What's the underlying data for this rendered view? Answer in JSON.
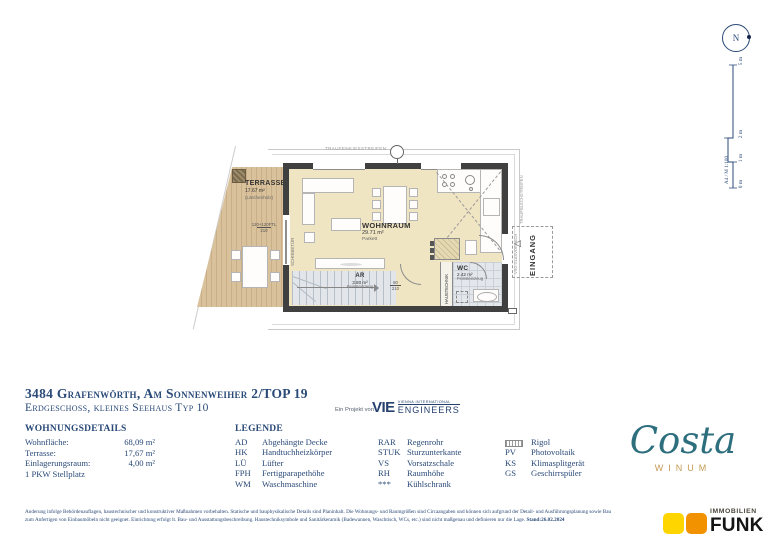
{
  "header": {
    "title": "3484 Grafenwörth, Am Sonnenweiher 2/TOP 19",
    "subtitle": "Erdgeschoss, kleines Seehaus Typ 10"
  },
  "details": {
    "heading": "WOHNUNGSDETAILS",
    "rows": [
      {
        "label": "Wohnfläche:",
        "value": "68,09 m²"
      },
      {
        "label": "Terrasse:",
        "value": "17,67 m²"
      },
      {
        "label": "Einlagerungsraum:",
        "value": "4,00 m²"
      }
    ],
    "note": "1 PKW Stellplatz"
  },
  "legend": {
    "heading": "LEGENDE",
    "c1": [
      {
        "a": "AD",
        "t": "Abgehängte Decke"
      },
      {
        "a": "HK",
        "t": "Handtuchheizkörper"
      },
      {
        "a": "LÜ",
        "t": "Lüfter"
      },
      {
        "a": "FPH",
        "t": "Fertigparapethöhe"
      },
      {
        "a": "WM",
        "t": "Waschmaschine"
      }
    ],
    "c2": [
      {
        "a": "RAR",
        "t": "Regenrohr"
      },
      {
        "a": "STUK",
        "t": "Sturzunterkante"
      },
      {
        "a": "VS",
        "t": "Vorsatzschale"
      },
      {
        "a": "RH",
        "t": "Raumhöhe"
      },
      {
        "a": "***",
        "t": "Kühlschrank"
      }
    ],
    "c3": [
      {
        "a": "",
        "t": "Rigol"
      },
      {
        "a": "PV",
        "t": "Photovoltaik"
      },
      {
        "a": "KS",
        "t": "Klimasplitgerät"
      },
      {
        "a": "GS",
        "t": "Geschirrspüler"
      }
    ]
  },
  "partner": {
    "prefix": "Ein Projekt von",
    "abbr": "VIE",
    "top": "VIENNA INTERNATIONAL",
    "bottom": "ENGINEERS"
  },
  "brand": {
    "script": "Costa",
    "sub": "WINUM",
    "teal": "#2e6f7e",
    "gold": "#c49a53"
  },
  "funk": {
    "top": "IMMOBILIEN",
    "bottom": "FUNK",
    "yellow": "#ffd500",
    "orange": "#f39200"
  },
  "fineprint": {
    "line1": "Änderung infolge Behördenauflagen, haustechnischer und konstruktiver Maßnahmen vorbehalten. Statische und bauphysikalische Details sind Planinhalt. Die Wohnungs- und Raumgrößen sind Circaangaben und können sich aufgrund der Detail- und Ausführungsplanung sowie Bau",
    "line2": "zum Anfertigen von Einbaumöbeln nicht geeignet. Einrichtung erfolgt lt. Bau- und Ausstattungsbeschreibung. Haustechniksymbole und Sanitärkeramik (Badewannen, Waschtisch, WCs, etc.) sind nicht maßgenau und definieren nur die Lage. ",
    "stand": "Stand:26.02.2024"
  },
  "north_label": "N",
  "scalebar": {
    "label": "A4 / M 1:100",
    "tick_0": "0 m",
    "tick_1": "1 m",
    "tick_2": "2 m",
    "tick_5": "5 m"
  },
  "plan": {
    "wohnraum": {
      "name": "WOHNRAUM",
      "area": "29.71 m²",
      "floor": "Parkett"
    },
    "terrasse": {
      "name": "TERRASSE",
      "area": "17.67 m²",
      "floor": "(Lärchenholz)"
    },
    "ar": {
      "name": "AR",
      "area": "3.80 m²",
      "floor": "Feinsteinzeug"
    },
    "wc": {
      "name": "WC",
      "area": "2.42 m²",
      "floor": "Feinsteinzeug"
    },
    "haustechnik": "HAUSTECHNIK",
    "eingang": "EINGANG",
    "schiebetuer": "SCHIEBETÜR",
    "vsg_glasvordach": "VSG GLASVORDACH",
    "traufenkiesstreifen": "TRAUFENKIESSTREIFEN",
    "traufblechstreifen": "TRAUFBLECHSTREIFEN",
    "dim_door": "120+120FTL",
    "dim_door_h": "210",
    "dim_ar_door": "80",
    "dim_ar_door_h": "210"
  }
}
